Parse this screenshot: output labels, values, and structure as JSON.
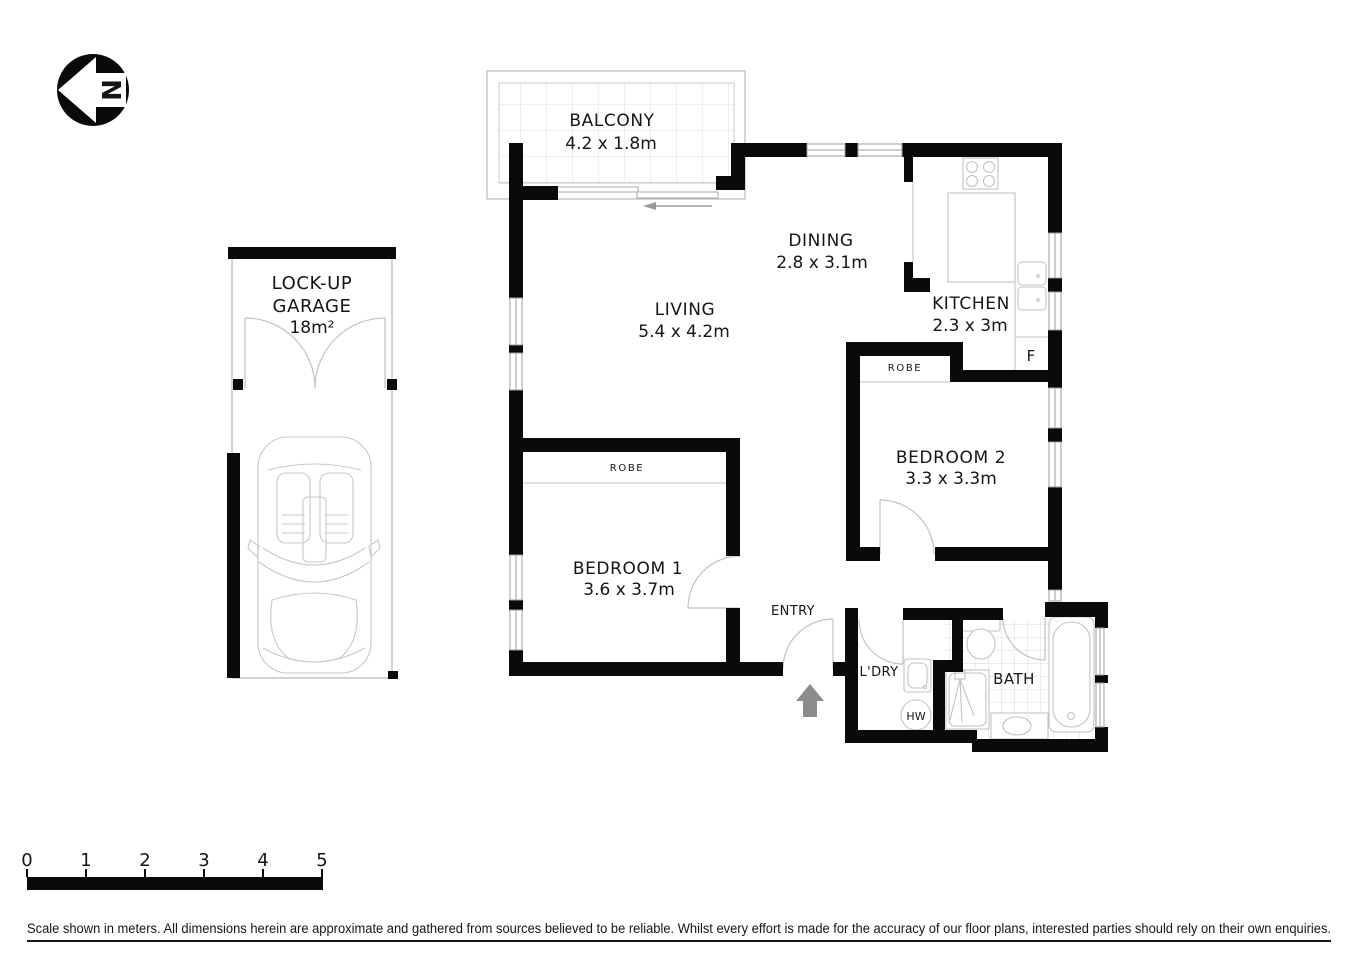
{
  "north_indicator": {
    "letter": "N"
  },
  "rooms": {
    "balcony": {
      "name": "BALCONY",
      "dims": "4.2 x 1.8m"
    },
    "garage": {
      "name_line1": "LOCK-UP",
      "name_line2": "GARAGE",
      "area": "18m²"
    },
    "living": {
      "name": "LIVING",
      "dims": "5.4 x 4.2m"
    },
    "dining": {
      "name": "DINING",
      "dims": "2.8 x 3.1m"
    },
    "kitchen": {
      "name": "KITCHEN",
      "dims": "2.3 x 3m",
      "fridge_label": "F"
    },
    "bedroom1": {
      "name": "BEDROOM 1",
      "dims": "3.6 x 3.7m",
      "robe_label": "ROBE"
    },
    "bedroom2": {
      "name": "BEDROOM 2",
      "dims": "3.3 x 3.3m",
      "robe_label": "ROBE"
    },
    "entry": {
      "label": "ENTRY"
    },
    "laundry": {
      "label": "L'DRY",
      "hot_water_label": "HW"
    },
    "bath": {
      "label": "BATH"
    }
  },
  "scale_bar": {
    "ticks": [
      "0",
      "1",
      "2",
      "3",
      "4",
      "5"
    ]
  },
  "disclaimer": {
    "text": "Scale shown in meters. All dimensions herein are approximate and gathered from sources believed to be  reliable. Whilst every effort is made for the accuracy of our floor plans, interested parties should rely on their own enquiries."
  },
  "colors": {
    "wall": "#0a0a0a",
    "fixture_line": "#c2c2c2",
    "thin_wall_line": "#b8b8b8",
    "tile_line": "#dcdcdc",
    "entry_arrow": "#8c8c8c",
    "text": "#151515"
  }
}
